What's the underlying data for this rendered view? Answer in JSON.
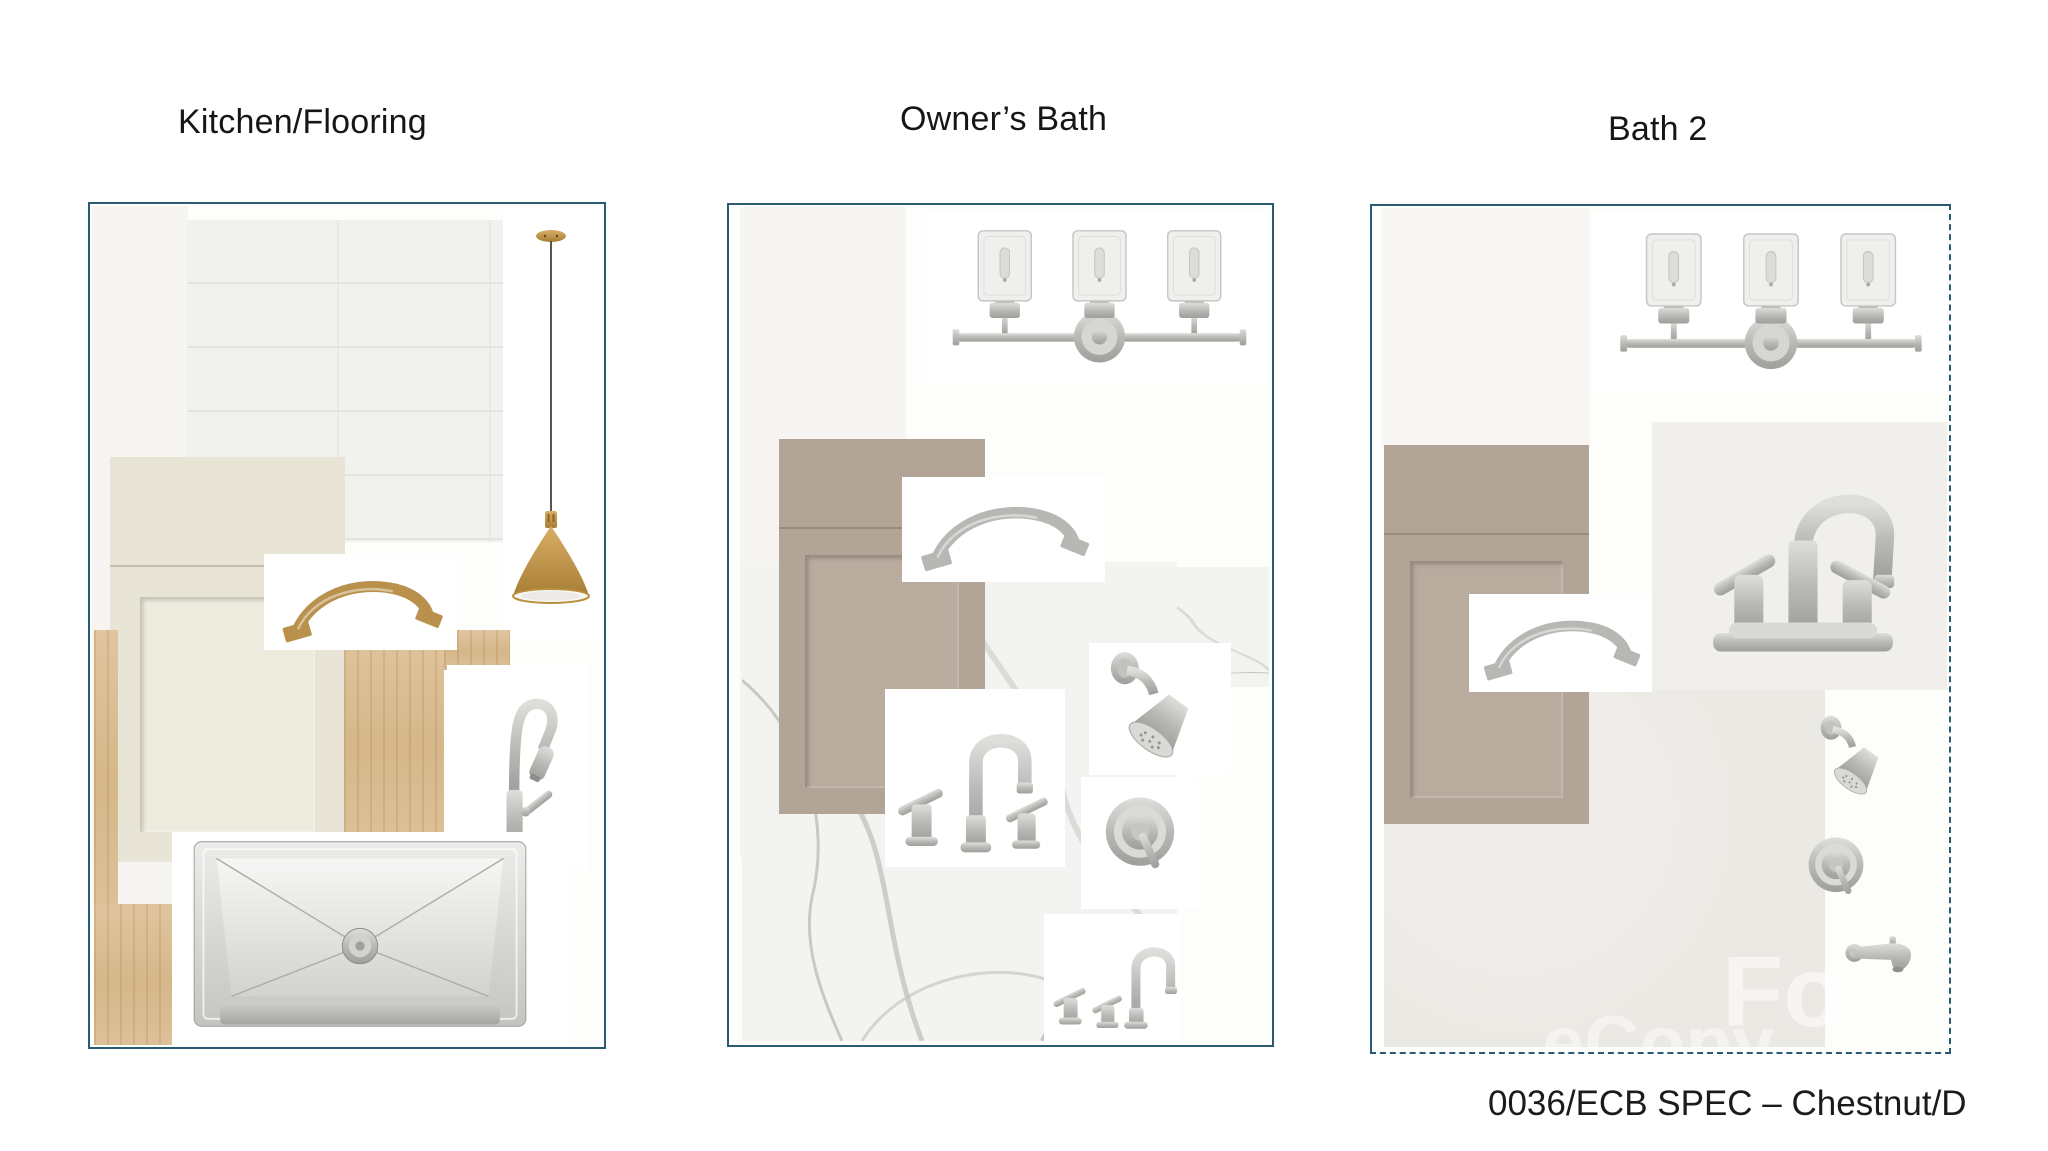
{
  "page": {
    "background": "#ffffff",
    "footer": "0036/ECB SPEC – Chestnut/D",
    "watermark": {
      "primary": "Fo",
      "secondary": "eCopy"
    }
  },
  "style": {
    "panel_border_color": "#2b5b72",
    "brass": "#b9914c",
    "brushed_nickel": "#b7b7b3",
    "cream_cabinet": "#e8e5d7",
    "taupe_cabinet": "#b2a497",
    "light_oak_floor": "#d9bc92",
    "subway_tile": "#f1f1ef",
    "marble_tile": "#f3f3f1",
    "gray_tile": "#ebe9e4"
  },
  "panels": [
    {
      "title": "Kitchen/Flooring",
      "items": [
        "subway-tile-swatch",
        "cream-shaker-cabinet-door",
        "light-oak-flooring",
        "brass-arch-cabinet-pull",
        "brass-cone-pendant-light",
        "brushed-nickel-pulldown-kitchen-faucet",
        "stainless-steel-undermount-sink"
      ]
    },
    {
      "title": "Owner’s Bath",
      "items": [
        "three-light-seeded-glass-vanity-light",
        "taupe-shaker-cabinet-door",
        "brushed-nickel-arch-cabinet-pull",
        "marble-look-tile-swatch",
        "brushed-nickel-widespread-lavatory-faucet",
        "brushed-nickel-shower-head",
        "brushed-nickel-shower-valve-trim",
        "brushed-nickel-roman-tub-faucet"
      ]
    },
    {
      "title": "Bath 2",
      "items": [
        "three-light-seeded-glass-vanity-light",
        "taupe-shaker-cabinet-door",
        "brushed-nickel-centerset-lavatory-faucet",
        "brushed-nickel-arch-cabinet-pull",
        "gray-tile-swatch",
        "brushed-nickel-shower-head",
        "brushed-nickel-shower-valve-trim",
        "brushed-nickel-tub-spout"
      ]
    }
  ]
}
